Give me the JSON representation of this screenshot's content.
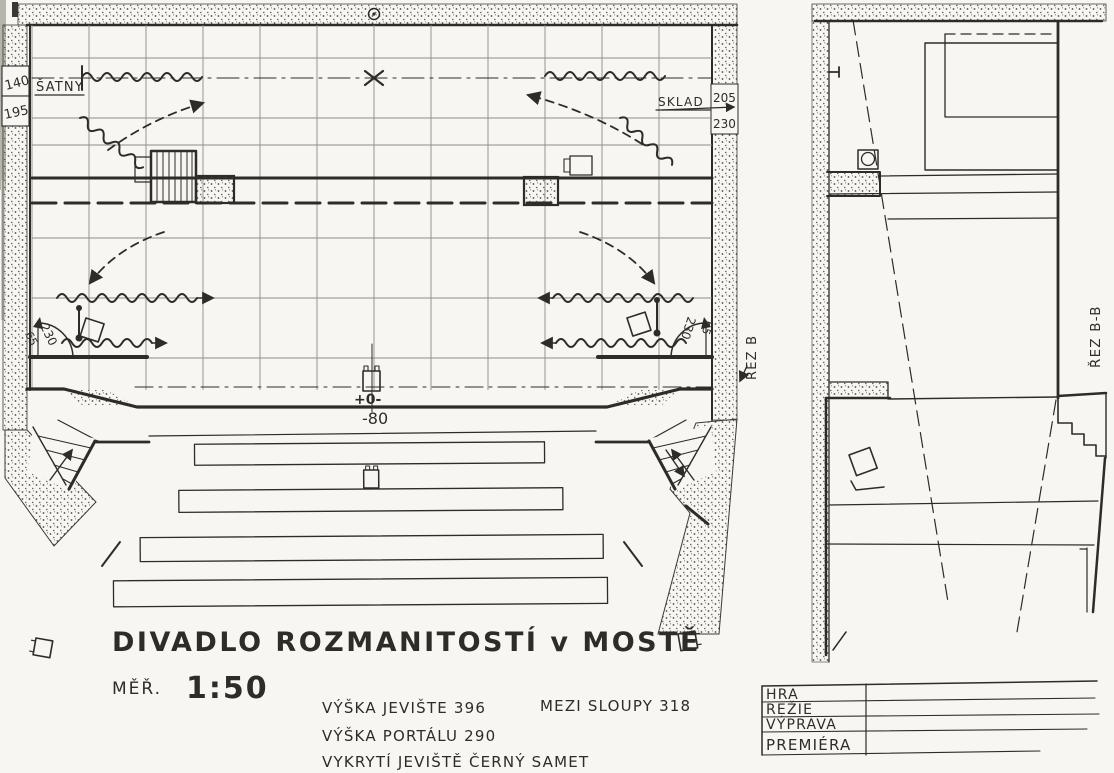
{
  "drawing": {
    "title": "DIVADLO ROZMANITOSTÍ v MOSTĚ",
    "scale_label": "MĚŘ.",
    "scale_value": "1:50"
  },
  "notes": {
    "stage_height": "VÝŠKA JEVIŠTE 396",
    "between_columns": "MEZI SLOUPY 318",
    "portal_height": "VÝŠKA PORTÁLU 290",
    "masking": "VYKRYTÍ JEVIŠTĚ ČERNÝ SAMET"
  },
  "plan": {
    "labels": {
      "dressing_rooms": "ŠATNY",
      "storage": "SKLAD",
      "section_cut": "ŘEZ B"
    },
    "dims": {
      "left_upper": "140",
      "left_lower": "195",
      "storage_a": "205",
      "storage_b": "230",
      "door_left_r": "230",
      "door_left_o": "65",
      "door_right_r": "230",
      "door_right_o": "65",
      "level_zero": "+0-",
      "level_low": "-80"
    }
  },
  "section": {
    "label": "ŘEZ B-B"
  },
  "title_block": {
    "rows": [
      {
        "label": "HRA",
        "value": ""
      },
      {
        "label": "REŽIE",
        "value": ""
      },
      {
        "label": "VÝPRAVA",
        "value": ""
      },
      {
        "label": "PREMIÉRA",
        "value": ""
      }
    ]
  },
  "colors": {
    "paper": "#f7f6f2",
    "ink": "#2e2c28",
    "pencil": "#8f8c84"
  }
}
